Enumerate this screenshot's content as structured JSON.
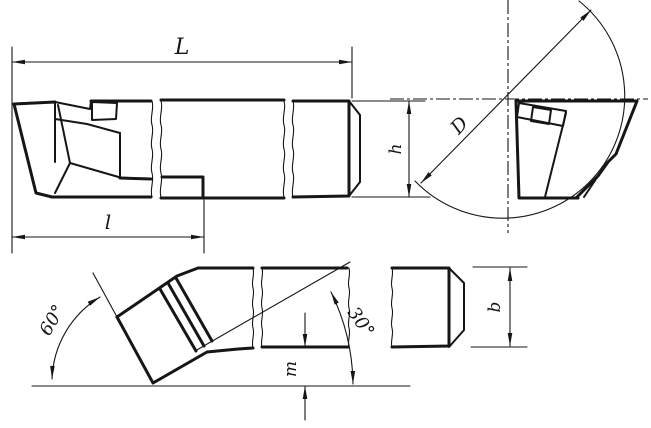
{
  "drawing": {
    "title": "bent-head turning tool, three-view engineering drawing",
    "labels": {
      "overall_length": "L",
      "head_length": "l",
      "diameter": "D",
      "shank_height": "h",
      "shank_width": "b",
      "tip_offset": "m",
      "main_angle": "60°",
      "secondary_angle": "30°"
    },
    "dimensions": [
      {
        "symbol": "L",
        "meaning": "overall length, top dimension of side view"
      },
      {
        "symbol": "l",
        "meaning": "head length, lower-left dimension of side view"
      },
      {
        "symbol": "D",
        "meaning": "diameter across the circle in the end view"
      },
      {
        "symbol": "h",
        "meaning": "shank height, right side of side view"
      },
      {
        "symbol": "b",
        "meaning": "shank width, right side of plan view"
      },
      {
        "symbol": "m",
        "meaning": "tip drop below shank, plan view"
      },
      {
        "symbol": "60°",
        "meaning": "main cutting edge angle, plan view left"
      },
      {
        "symbol": "30°",
        "meaning": "secondary edge angle, plan view right"
      }
    ],
    "colors": {
      "ink": "#161616",
      "background": "#ffffff"
    }
  }
}
